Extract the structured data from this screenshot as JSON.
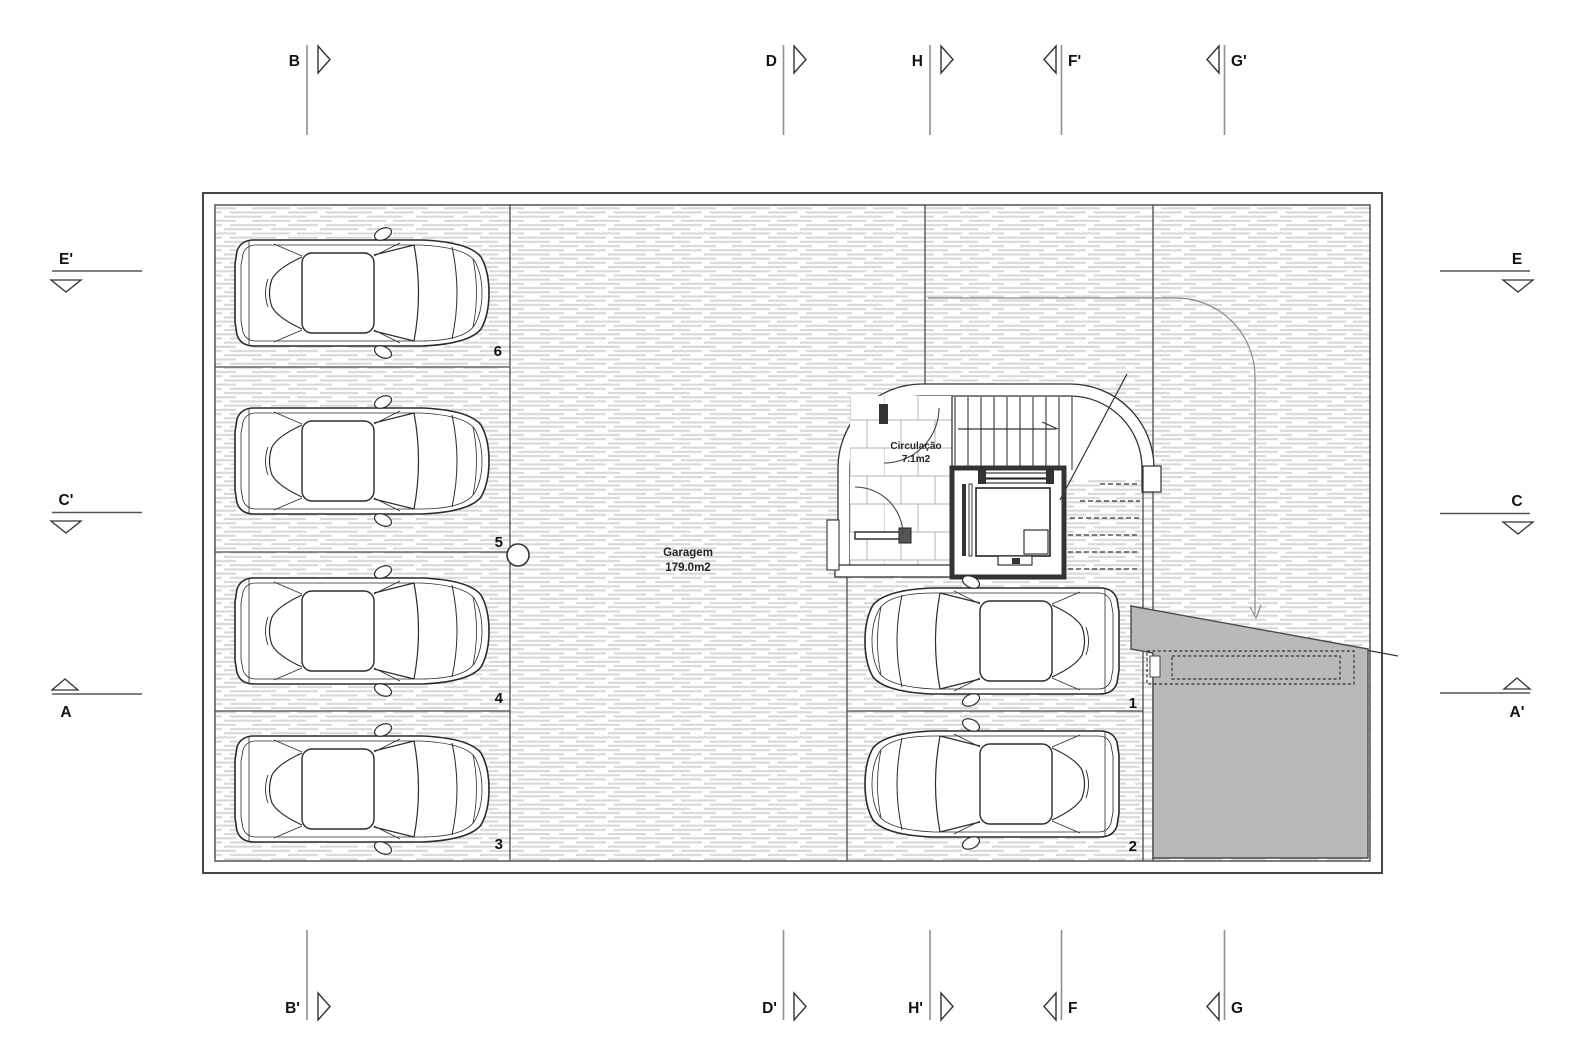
{
  "rooms": {
    "garage": {
      "name": "Garagem",
      "area": "179.0m2"
    },
    "circulation": {
      "name": "Circulação",
      "area": "7.1m2"
    }
  },
  "parking": {
    "numbers": [
      "1",
      "2",
      "3",
      "4",
      "5",
      "6"
    ]
  },
  "markers": {
    "top": [
      {
        "label": "B",
        "direction": "right"
      },
      {
        "label": "D",
        "direction": "right"
      },
      {
        "label": "H",
        "direction": "right"
      },
      {
        "label": "F'",
        "direction": "left"
      },
      {
        "label": "G'",
        "direction": "left"
      }
    ],
    "bottom": [
      {
        "label": "B'",
        "direction": "right"
      },
      {
        "label": "D'",
        "direction": "right"
      },
      {
        "label": "H'",
        "direction": "right"
      },
      {
        "label": "F",
        "direction": "left"
      },
      {
        "label": "G",
        "direction": "left"
      }
    ],
    "left": [
      {
        "label": "E'",
        "direction": "down"
      },
      {
        "label": "C'",
        "direction": "down"
      },
      {
        "label": "A",
        "direction": "up"
      }
    ],
    "right": [
      {
        "label": "E",
        "direction": "down"
      },
      {
        "label": "C",
        "direction": "down"
      },
      {
        "label": "A'",
        "direction": "up"
      }
    ]
  },
  "colors": {
    "ramp_fill": "#b9b9b9",
    "floor_hatch_line": "#d8d8d8",
    "wall_line": "#3f3f3f"
  }
}
